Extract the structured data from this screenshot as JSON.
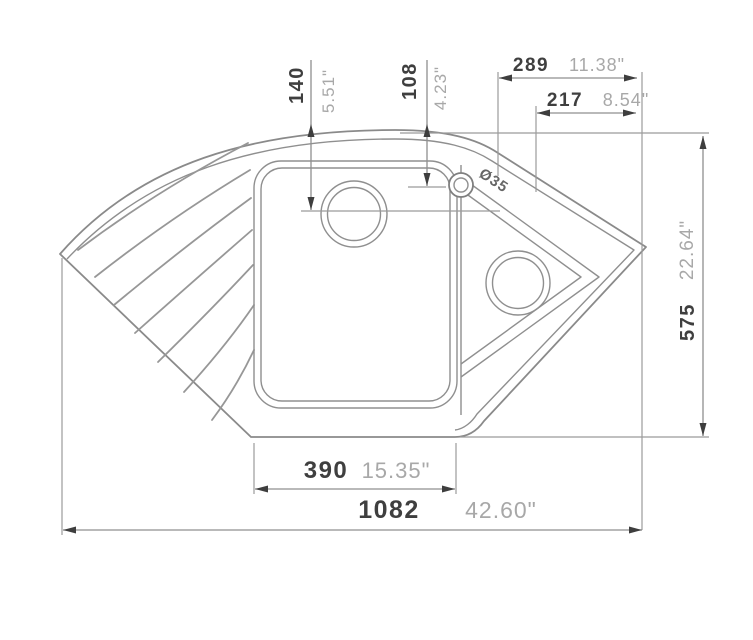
{
  "drawing": {
    "title": "Corner kitchen sink technical drawing (top view)",
    "dims": {
      "d289": {
        "mm": "289",
        "inch": "11.38\""
      },
      "d217": {
        "mm": "217",
        "inch": "8.54\""
      },
      "d140": {
        "mm": "140",
        "inch": "5.51\""
      },
      "d108": {
        "mm": "108",
        "inch": "4.23\""
      },
      "d575": {
        "mm": "575",
        "inch": "22.64\""
      },
      "d390": {
        "mm": "390",
        "inch": "15.35\""
      },
      "d1082": {
        "mm": "1082",
        "inch": "42.60\""
      },
      "tap_hole": {
        "label": "Ø35"
      }
    },
    "colors": {
      "background": "#ffffff",
      "line": "#8a8a8a",
      "mm_text": "#3f3f3f",
      "inch_text": "#a8a8a8",
      "arrow": "#3e3e3e"
    }
  }
}
